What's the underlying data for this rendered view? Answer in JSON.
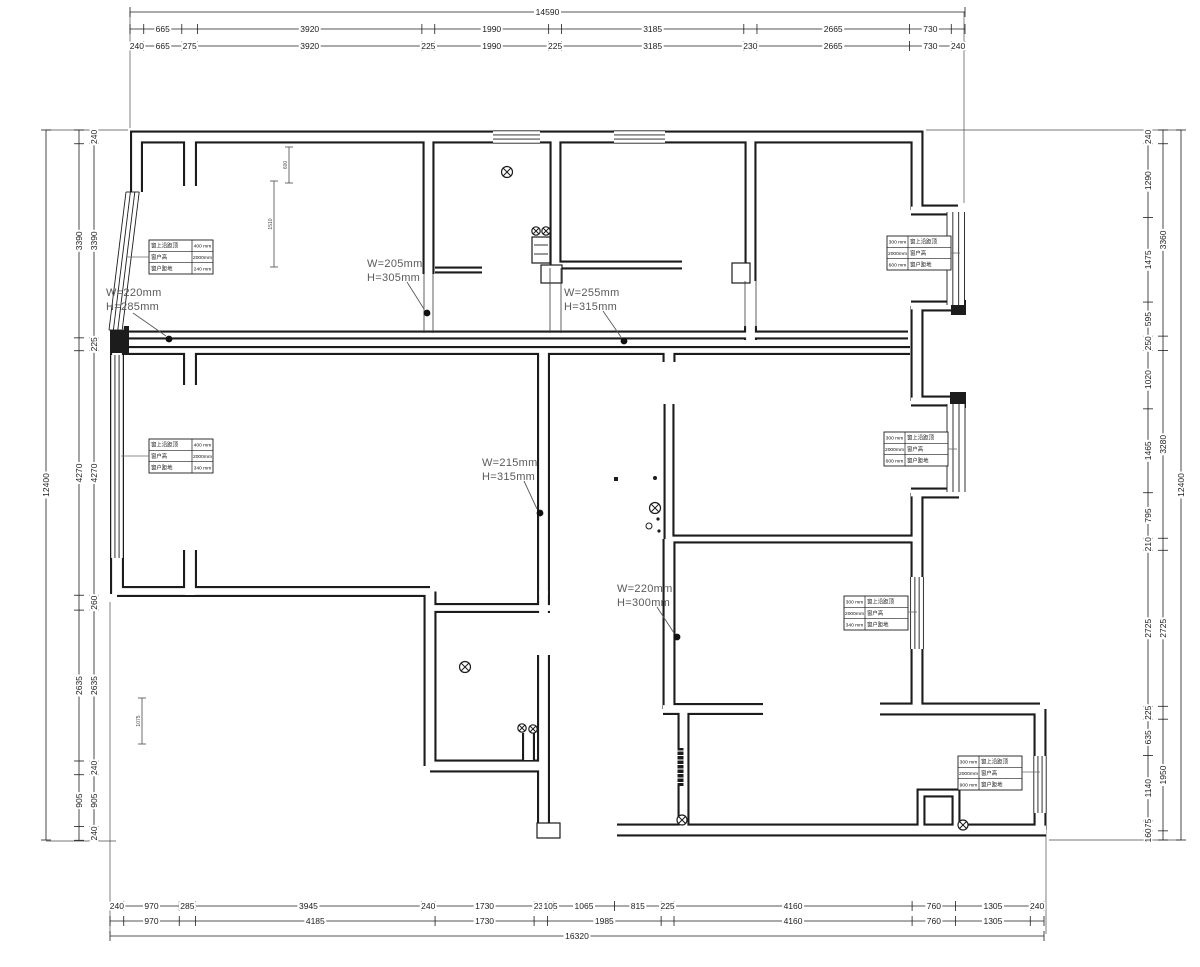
{
  "drawing": {
    "type": "floor-plan",
    "line_color": "#1c1c1c",
    "annotation_color": "#5a5a5a"
  },
  "dims": {
    "top_total": [
      [
        14590,
        "14590"
      ]
    ],
    "top_major": [
      [
        240,
        null
      ],
      [
        665,
        "665"
      ],
      [
        275,
        null
      ],
      [
        3920,
        "3920"
      ],
      [
        225,
        null
      ],
      [
        1990,
        "1990"
      ],
      [
        225,
        null
      ],
      [
        3185,
        "3185"
      ],
      [
        230,
        null
      ],
      [
        2665,
        "2665"
      ],
      [
        730,
        "730"
      ],
      [
        240,
        null
      ]
    ],
    "top_detail": [
      [
        240,
        "240"
      ],
      [
        665,
        "665"
      ],
      [
        275,
        "275"
      ],
      [
        3920,
        "3920"
      ],
      [
        225,
        "225"
      ],
      [
        1990,
        "1990"
      ],
      [
        225,
        "225"
      ],
      [
        3185,
        "3185"
      ],
      [
        230,
        "230"
      ],
      [
        2665,
        "2665"
      ],
      [
        730,
        "730"
      ],
      [
        240,
        "240"
      ]
    ],
    "bottom_detail": [
      [
        240,
        "240"
      ],
      [
        970,
        "970"
      ],
      [
        285,
        "285"
      ],
      [
        3945,
        "3945"
      ],
      [
        240,
        "240"
      ],
      [
        1730,
        "1730"
      ],
      [
        235,
        "235"
      ],
      [
        105,
        "105"
      ],
      [
        1065,
        "1065"
      ],
      [
        815,
        "815"
      ],
      [
        225,
        "225"
      ],
      [
        4160,
        "4160"
      ],
      [
        760,
        "760"
      ],
      [
        1305,
        "1305"
      ],
      [
        240,
        "240"
      ]
    ],
    "bottom_major": [
      [
        240,
        null
      ],
      [
        970,
        "970"
      ],
      [
        285,
        null
      ],
      [
        4185,
        "4185"
      ],
      [
        1730,
        "1730"
      ],
      [
        235,
        null
      ],
      [
        1985,
        "1985"
      ],
      [
        225,
        null
      ],
      [
        4160,
        "4160"
      ],
      [
        760,
        "760"
      ],
      [
        1305,
        "1305"
      ],
      [
        240,
        null
      ]
    ],
    "bottom_total": [
      [
        16320,
        "16320"
      ]
    ],
    "left_detail": [
      [
        240,
        "240"
      ],
      [
        3390,
        "3390"
      ],
      [
        225,
        "225"
      ],
      [
        4270,
        "4270"
      ],
      [
        260,
        "260"
      ],
      [
        2635,
        "2635"
      ],
      [
        240,
        "240"
      ],
      [
        905,
        "905"
      ],
      [
        240,
        "240"
      ]
    ],
    "left_major": [
      [
        240,
        null
      ],
      [
        3390,
        "3390"
      ],
      [
        225,
        null
      ],
      [
        4270,
        "4270"
      ],
      [
        260,
        null
      ],
      [
        2635,
        "2635"
      ],
      [
        240,
        null
      ],
      [
        905,
        "905"
      ],
      [
        240,
        null
      ]
    ],
    "left_total": [
      [
        12400,
        "12400"
      ]
    ],
    "right_detail": [
      [
        240,
        "240"
      ],
      [
        1290,
        "1290"
      ],
      [
        1475,
        "1475"
      ],
      [
        595,
        "595"
      ],
      [
        250,
        "250"
      ],
      [
        1020,
        "1020"
      ],
      [
        1465,
        "1465"
      ],
      [
        795,
        "795"
      ],
      [
        210,
        "210"
      ],
      [
        2725,
        "2725"
      ],
      [
        225,
        "225"
      ],
      [
        635,
        "635"
      ],
      [
        1140,
        "1140"
      ],
      [
        175,
        "175"
      ],
      [
        160,
        "160"
      ]
    ],
    "right_major": [
      [
        240,
        null
      ],
      [
        3360,
        "3360"
      ],
      [
        250,
        null
      ],
      [
        3280,
        "3280"
      ],
      [
        210,
        null
      ],
      [
        2725,
        "2725"
      ],
      [
        225,
        null
      ],
      [
        1950,
        "1950"
      ],
      [
        160,
        null
      ]
    ],
    "right_total": [
      [
        12400,
        "12400"
      ]
    ]
  },
  "beam_annotations": [
    {
      "line1": "W=220mm",
      "line2": "H=285mm"
    },
    {
      "line1": "W=205mm",
      "line2": "H=305mm"
    },
    {
      "line1": "W=255mm",
      "line2": "H=315mm"
    },
    {
      "line1": "W=215mm",
      "line2": "H=315mm"
    },
    {
      "line1": "W=220mm",
      "line2": "H=300mm"
    }
  ],
  "window_tables": {
    "row_labels": [
      "窗上沿距顶",
      "窗户高",
      "窗户距地"
    ],
    "tables": [
      {
        "values": [
          "400 mm",
          "2000mm",
          "240 mm"
        ]
      },
      {
        "values": [
          "300 mm",
          "2000mm",
          "600 mm"
        ]
      },
      {
        "values": [
          "400 mm",
          "2000mm",
          "340 mm"
        ]
      },
      {
        "values": [
          "300 mm",
          "2000mm",
          "600 mm"
        ]
      },
      {
        "values": [
          "300 mm",
          "2000mm",
          "340 mm"
        ]
      },
      {
        "values": [
          "300 mm",
          "2000mm",
          "900 mm"
        ]
      }
    ]
  },
  "interior_markers": [
    {
      "label": "600"
    },
    {
      "label": "1510"
    },
    {
      "label": "1075"
    }
  ]
}
